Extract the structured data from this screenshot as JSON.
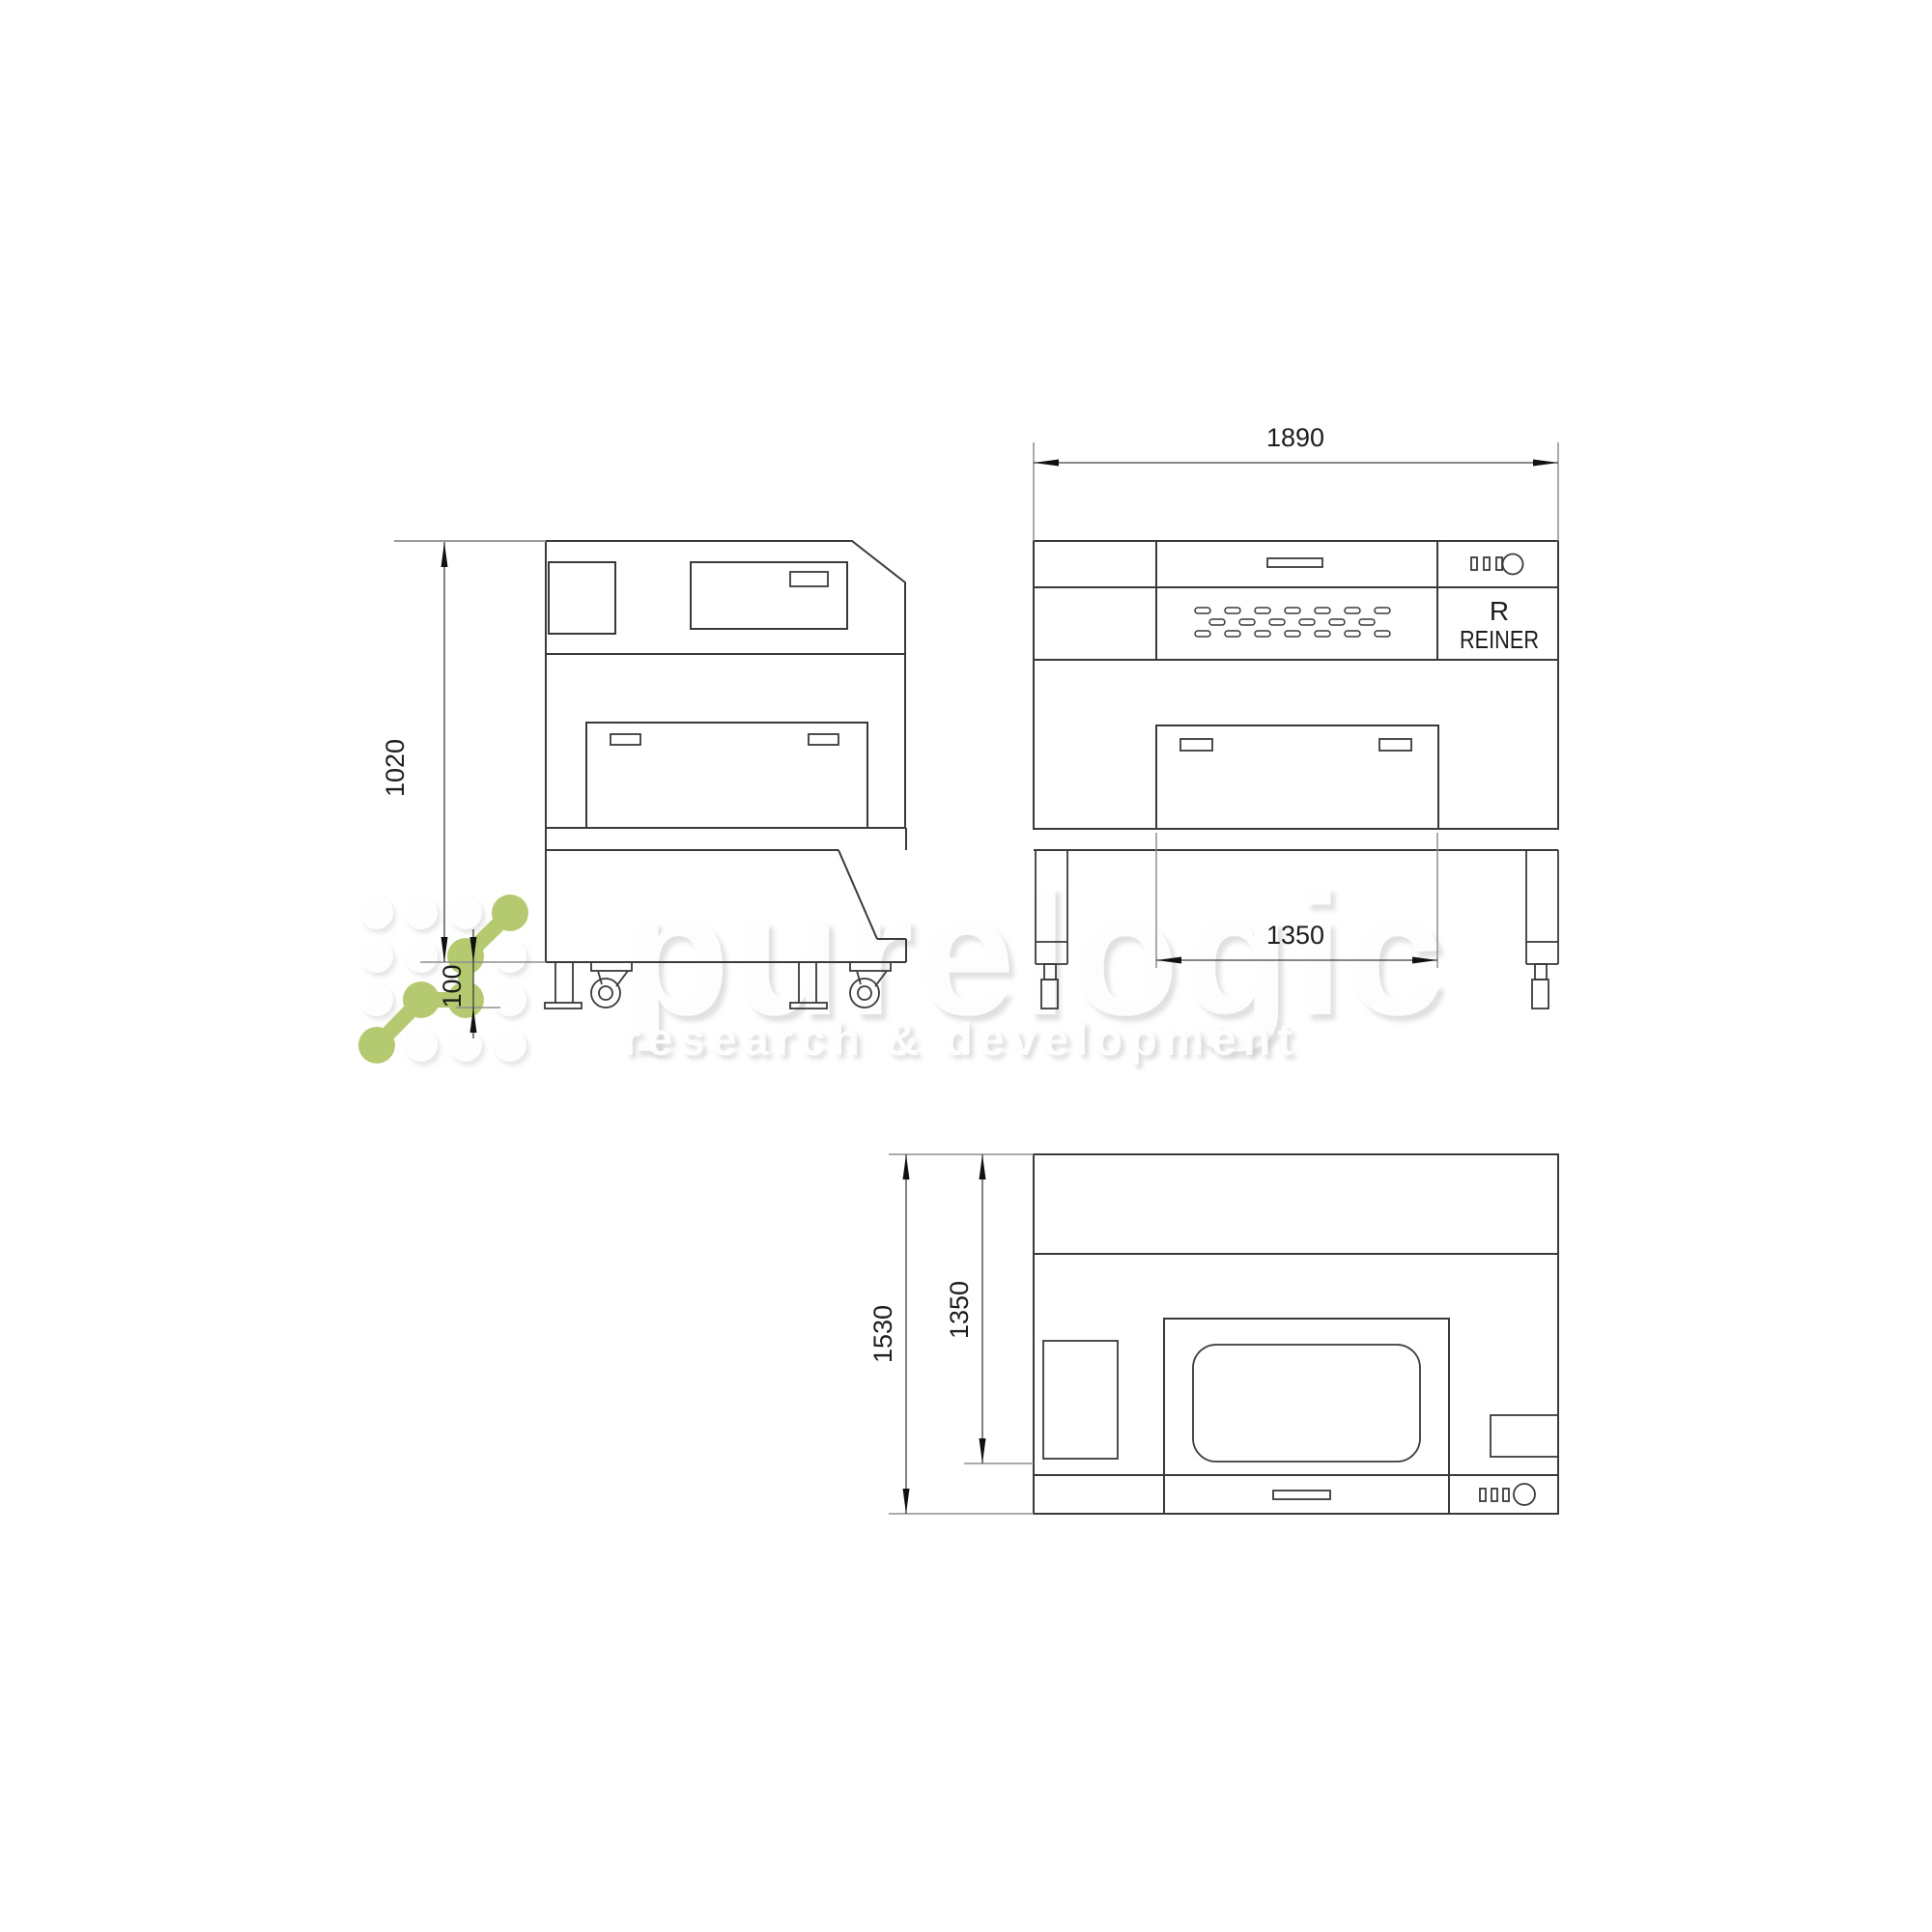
{
  "canvas": {
    "background": "#ffffff"
  },
  "drawing": {
    "line_color": "#3a3a3a",
    "dim_line_color": "#3f3f3f",
    "ext_line_color": "#9b9b9b",
    "text_color": "#1d1d1d",
    "dimensions": {
      "front_width": "1890",
      "side_height": "1020",
      "caster_height": "100",
      "front_inner_width": "1350",
      "top_depth": "1530",
      "top_inner_depth": "1350"
    },
    "brand_badge": {
      "initial": "R",
      "name": "REINER"
    }
  },
  "watermark": {
    "wordmark": "purelogic",
    "tagline": "research & development",
    "logo_green": "#b5ca70"
  }
}
